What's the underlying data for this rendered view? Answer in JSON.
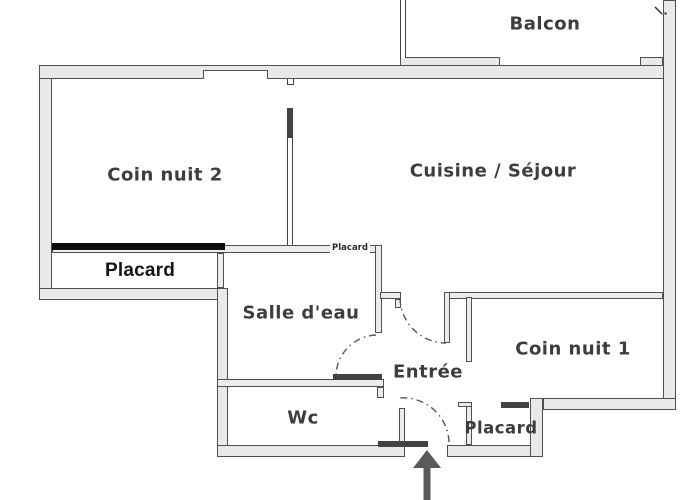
{
  "plan": {
    "title": "apartment floor plan",
    "labels": {
      "balcon": "Balcon",
      "coin_nuit_2": "Coin nuit 2",
      "cuisine_sejour": "Cuisine / Séjour",
      "placard_nuit2": "Placard",
      "placard_mur": "Placard",
      "salle_deau": "Salle d'eau",
      "entree": "Entrée",
      "coin_nuit_1": "Coin nuit 1",
      "wc": "Wc",
      "placard_entree": "Placard"
    },
    "symbols": {
      "entrance_arrow": "arrow pointing up at the entrance door",
      "door_swings": "dash-dot quarter-circle arcs for door swings"
    },
    "colors": {
      "wall_fill": "#e9e9e9",
      "wall_edge": "#505050",
      "closet_slider_black": "#0c0c0c",
      "dark_door_bar": "#434343",
      "label_text": "#3d3d3d",
      "background": "#ffffff"
    }
  }
}
